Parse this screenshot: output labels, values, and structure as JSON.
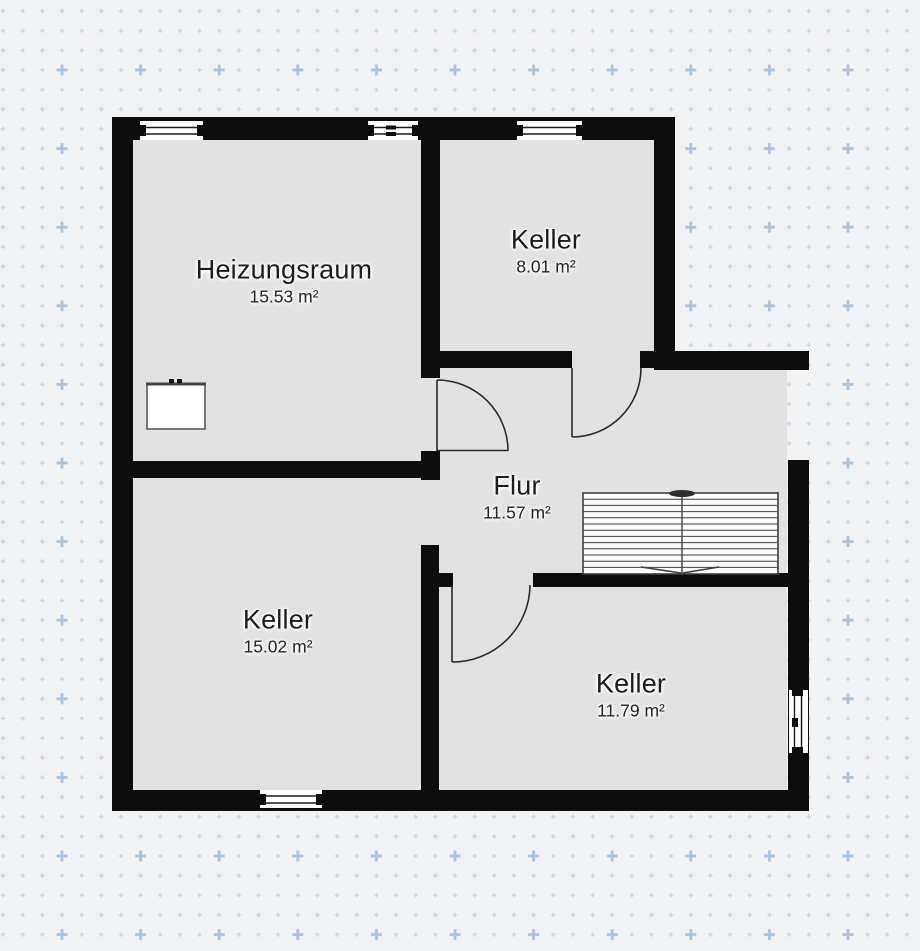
{
  "plan": {
    "type": "floor-plan",
    "rooms": [
      {
        "id": "heizungsraum",
        "name": "Heizungsraum",
        "area": "15.53 m²"
      },
      {
        "id": "keller-top",
        "name": "Keller",
        "area": "8.01 m²"
      },
      {
        "id": "flur",
        "name": "Flur",
        "area": "11.57 m²"
      },
      {
        "id": "keller-left",
        "name": "Keller",
        "area": "15.02 m²"
      },
      {
        "id": "keller-right",
        "name": "Keller",
        "area": "11.79 m²"
      }
    ],
    "colors": {
      "wall": "#0d0d0d",
      "room_fill": "#e2e2e2",
      "canvas_background": "#f2f3f5",
      "grid_dot_small": "#cbd2dd",
      "grid_plus_large": "#a8c2e4",
      "stair_fill": "#fbfbfb",
      "label_text": "#1c1c1e"
    }
  }
}
